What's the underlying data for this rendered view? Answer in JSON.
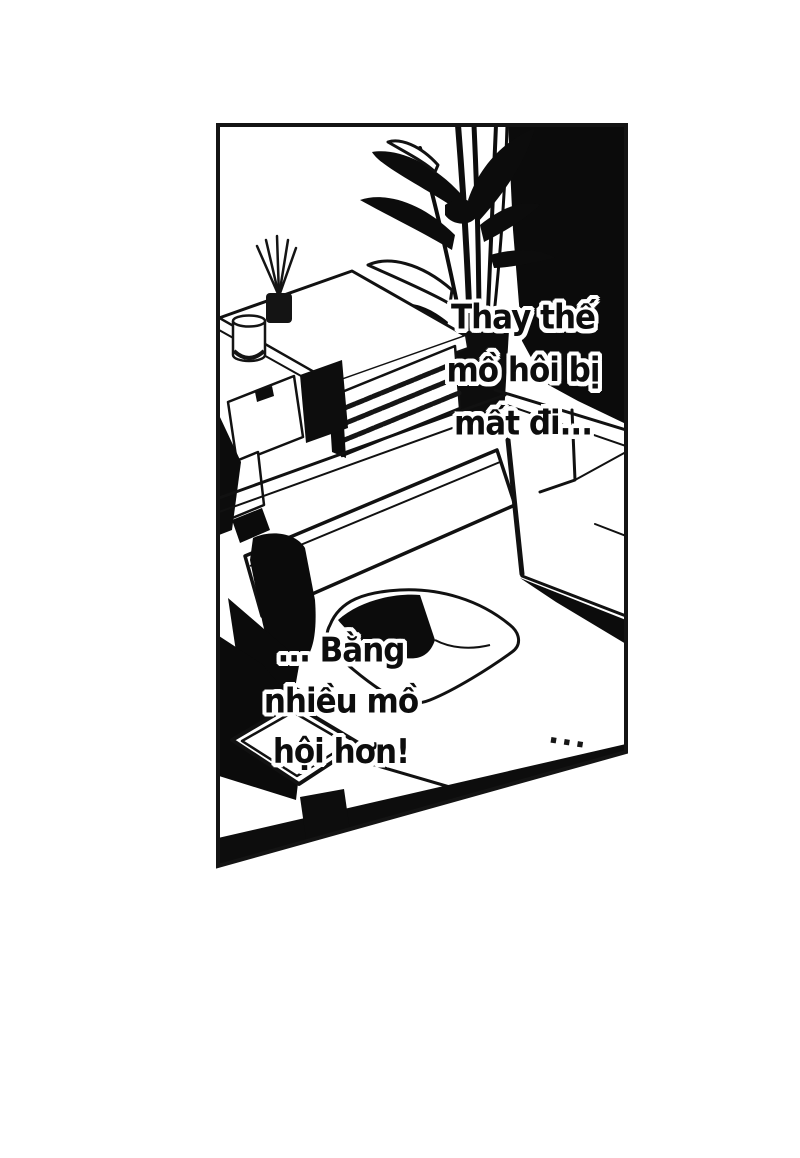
{
  "page": {
    "kind": "manga-page",
    "colors": {
      "paper": "#ffffff",
      "ink": "#0d0d0d",
      "border": "#141414"
    }
  },
  "dialogue": {
    "top_right": {
      "lines": [
        "Thay thế",
        "mồ hôi bị",
        "mất đi..."
      ]
    },
    "bottom_left": {
      "lines": [
        "... Bằng",
        "nhiều mồ",
        "hội hơn!"
      ]
    }
  },
  "ellipsis": "...",
  "scene_objects": [
    "wall-shadow",
    "houseplant",
    "plant-pot",
    "sideboard",
    "slatted-shelf",
    "reed-diffuser",
    "canister",
    "sofa-back",
    "sofa-armrest",
    "dark-object",
    "throw-pillow",
    "coffee-table",
    "tray"
  ]
}
